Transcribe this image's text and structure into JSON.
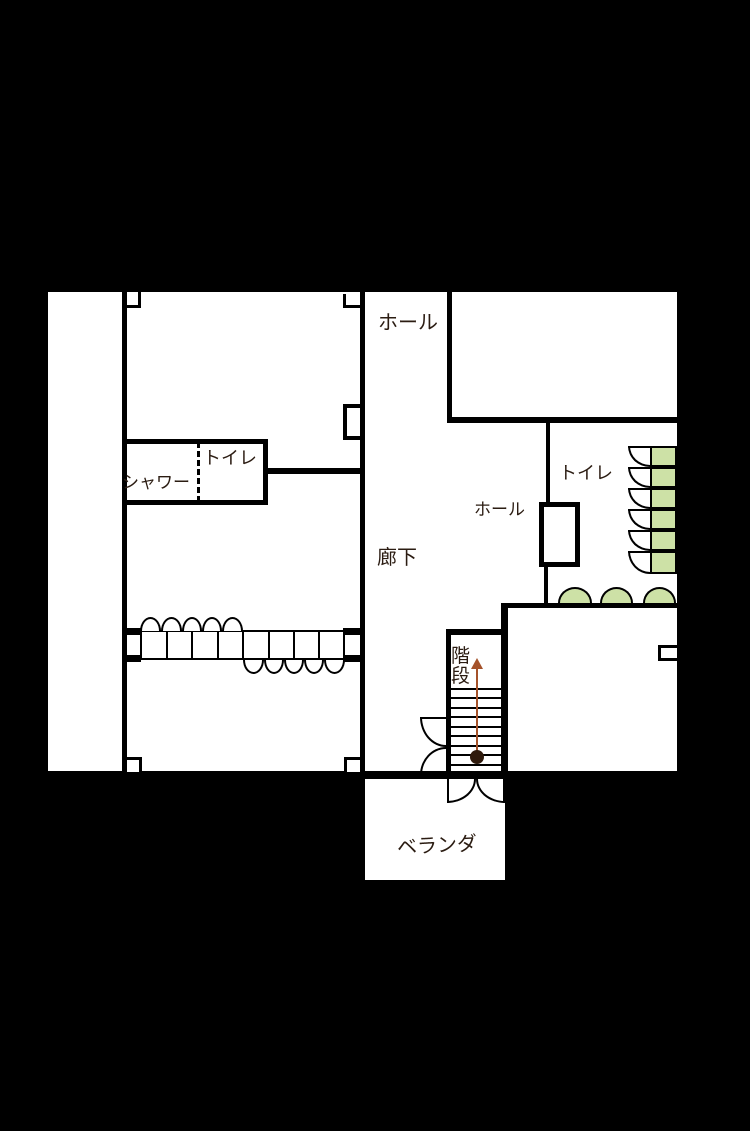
{
  "floorplan": {
    "labels": {
      "hall_top": "ホール",
      "toilet_left": "トイレ",
      "shower": "シャワー",
      "corridor": "廊下",
      "toilet_right": "トイレ",
      "hall_right": "ホール",
      "stairs": "階段",
      "veranda": "ベランダ"
    },
    "colors": {
      "background": "#000000",
      "floor": "#ffffff",
      "wall": "#000000",
      "text": "#2b1c12",
      "closet_green": "#cde1a6",
      "stair_arrow": "#a5522a",
      "stair_arrow_dot": "#2f1a0c"
    },
    "stairs": {
      "tread_count": 9,
      "arrow_direction": "up"
    }
  }
}
